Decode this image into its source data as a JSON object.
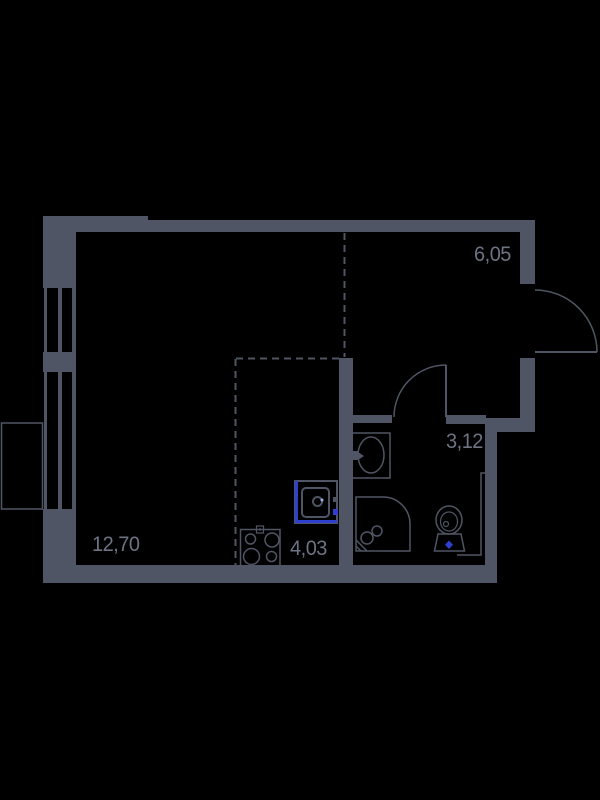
{
  "title": "Studio apartment floor plan",
  "colors": {
    "background": "#000000",
    "wall": "#4f5564",
    "label": "#6d7383",
    "accent_blue": "#2f3fd0",
    "accent_light": "#9fadea"
  },
  "rooms": [
    {
      "name": "living-room",
      "area": "12,70"
    },
    {
      "name": "hallway",
      "area": "6,05"
    },
    {
      "name": "bathroom",
      "area": "3,12"
    },
    {
      "name": "kitchen",
      "area": "4,03"
    }
  ],
  "fixtures": [
    "window-upper",
    "window-lower",
    "window-sill-box",
    "entrance-door",
    "bathroom-door",
    "kitchen-sink",
    "stove",
    "bathroom-sink",
    "shower",
    "toilet"
  ]
}
